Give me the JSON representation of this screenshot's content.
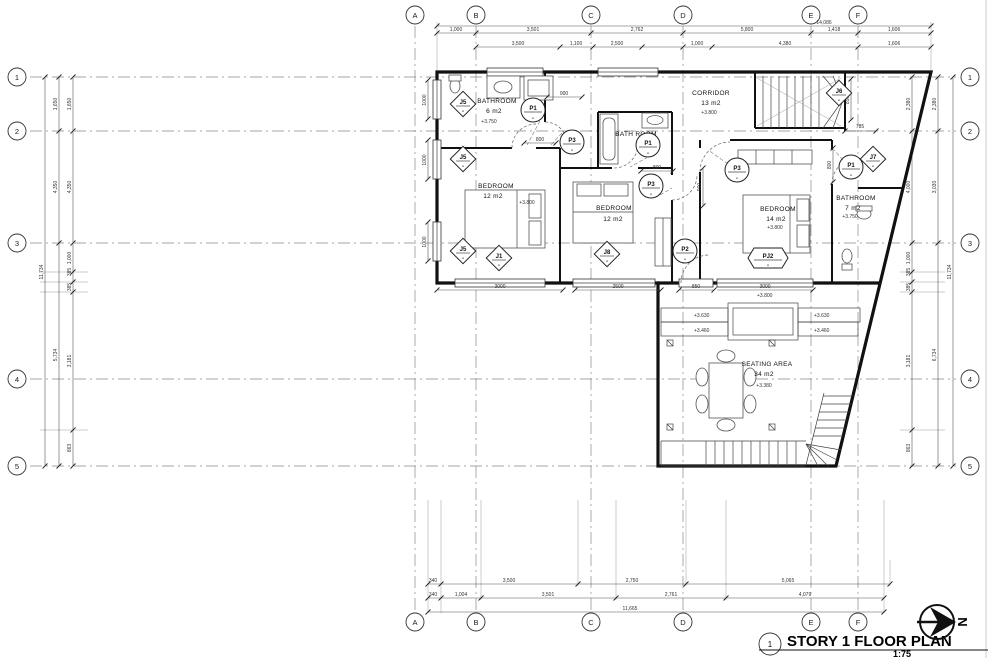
{
  "page": {
    "title_mark": "1",
    "title": "STORY 1 FLOOR PLAN",
    "scale": "1:75",
    "north": "N"
  },
  "grid": {
    "cols": [
      "A",
      "B",
      "C",
      "D",
      "E",
      "F"
    ],
    "rows": [
      "1",
      "2",
      "3",
      "4",
      "5"
    ]
  },
  "rooms": {
    "bath_tl": {
      "name": "BATHROOM",
      "area": "6 m2",
      "level": "+3.750"
    },
    "corridor": {
      "name": "CORRIDOR",
      "area": "13 m2",
      "level": "+3.800"
    },
    "bath_mid": {
      "name": "BATH ROOM"
    },
    "bed_left": {
      "name": "BEDROOM",
      "area": "12 m2",
      "level": "+3.800"
    },
    "bed_mid": {
      "name": "BEDROOM",
      "area": "12 m2"
    },
    "bed_right": {
      "name": "BEDROOM",
      "area": "14 m2",
      "level": "+3.800"
    },
    "bath_right": {
      "name": "BATHROOM",
      "area": "7 m2",
      "level": "+3.750"
    },
    "seating": {
      "name": "SEATING AREA",
      "area": "34 m2",
      "level": "+3.380"
    }
  },
  "tags": {
    "j5": "J5",
    "j1": "J1",
    "j6": "J6",
    "j7": "J7",
    "j8": "J8",
    "p1": "P1",
    "p2": "P2",
    "p3": "P3",
    "pj2": "PJ2",
    "dash": "-"
  },
  "dims": {
    "top_total": "14,086",
    "top_row1": [
      "1,000",
      "3,501",
      "2,762",
      "5,800",
      "1,418",
      "1,606"
    ],
    "top_row2": [
      "3,500",
      "1,100",
      "2,500",
      "1,000",
      "4,380",
      "1,606"
    ],
    "bottom_row1": [
      "340",
      "3,500",
      "2,750",
      "5,065"
    ],
    "bottom_row2": [
      "340",
      "1,004",
      "3,501",
      "2,761",
      "4,079"
    ],
    "bottom_total": "11,665",
    "left_total": "11,734",
    "left_mid": [
      "1,650",
      "4,350",
      "5,734"
    ],
    "left_inner": [
      "1,650",
      "4,350",
      "1,000",
      "385",
      "385",
      "3,181",
      "863"
    ],
    "right_total": "11,734",
    "right_mid": [
      "2,380",
      "3,030",
      "6,734"
    ],
    "right_inner": [
      "2,380",
      "4,000",
      "1,000",
      "385",
      "385",
      "3,181",
      "863"
    ],
    "interior_h": [
      "3000",
      "2500",
      "850",
      "3000"
    ],
    "interior_v": [
      "1000",
      "1000",
      "1000"
    ],
    "w900": "900",
    "w800a": "800",
    "w800b": "800",
    "v900": "900",
    "v850": "850",
    "v800": "800",
    "w785": "785"
  },
  "levels": {
    "terrace_hi": "+3.630",
    "terrace_lo": "+3.460",
    "entry": "+3.800"
  }
}
